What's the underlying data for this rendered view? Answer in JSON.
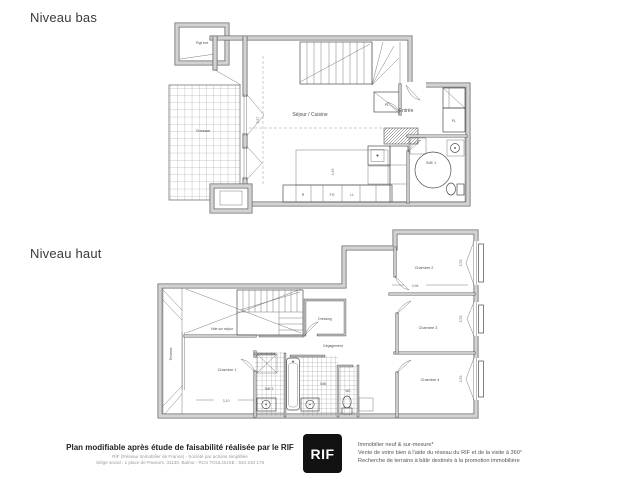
{
  "levels": {
    "bas": {
      "title": "Niveau bas",
      "rooms": {
        "rgt_ext": "Rgt ext",
        "terrasse": "Terrasse",
        "sejour_cuisine": "Séjour / Cuisine",
        "entree": "Entrée",
        "sde1": "SdE 1",
        "pl_stair": "PL",
        "pl_entree": "PL"
      },
      "appliances": {
        "refrigerator": "R",
        "oven": "FO",
        "washer": "LL"
      },
      "dims": {
        "sejour": "5,57",
        "cuisine": "4,49"
      }
    },
    "haut": {
      "title": "Niveau haut",
      "rooms": {
        "terrasse": "Terrasse",
        "vide": "Vide sur séjour",
        "dressing": "Dressing",
        "degagement": "Dégagement",
        "chambre1": "Chambre 1",
        "chambre2": "Chambre 2",
        "chambre3": "Chambre 3",
        "chambre4": "Chambre 4",
        "sde2": "SdE 2",
        "sdb": "SdB",
        "wc": "WC"
      },
      "dims": {
        "window2": "2,53",
        "window3": "2,53",
        "window4": "2,53",
        "chambre2_width": "3,96",
        "chambre1_width": "3,10"
      }
    }
  },
  "footer": {
    "title": "Plan modifiable après étude de faisabilité réalisée par le RIF",
    "company_line": "RIF (Réseau Immobilier de France) - Société par actions simplifiée",
    "address_line": "Siège social : 1 place de Paveurs, 31130, Balma - RCS TOULOUSE : 534 234 178",
    "logo": "RIF",
    "services": [
      "Immobilier neuf & sur-mesure*",
      "Vente de votre bien à l'aide du réseau du RIF et de la visite à 360°",
      "Recherche de terrains à bâtir destinés à la promotion immobilière"
    ]
  },
  "colors": {
    "wall_fill": "#d2d2d2",
    "wall_edge": "#6b6b6b",
    "line": "#4d4d4d",
    "logo_bg": "#121212"
  }
}
